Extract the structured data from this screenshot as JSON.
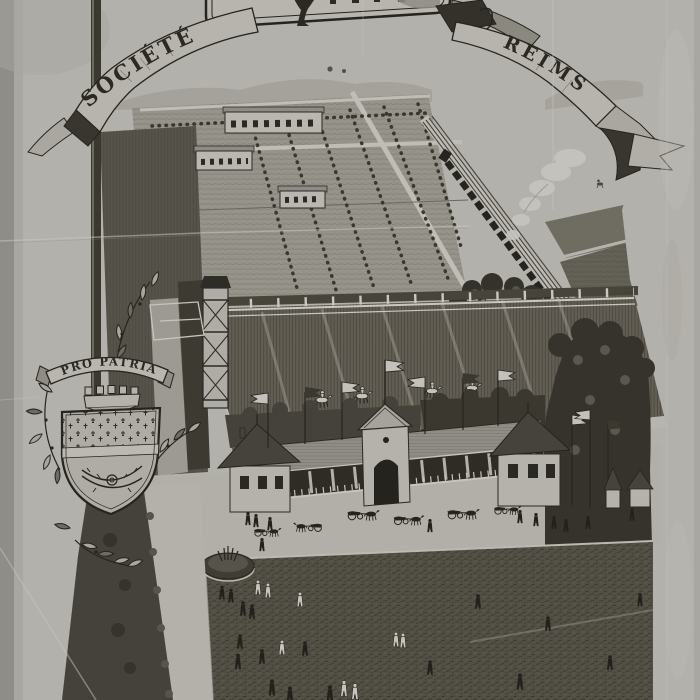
{
  "banner": {
    "left_text": "SOCIÉTÉ",
    "right_text": "REIMS"
  },
  "arms": {
    "motto": "PRO PATRIA"
  },
  "garden": {
    "letter": "R"
  },
  "palette": {
    "paper": "#b3b1ab",
    "ink": "#26241e",
    "field": "#625e54",
    "lawn": "#524f45",
    "trees": "#35332c"
  }
}
